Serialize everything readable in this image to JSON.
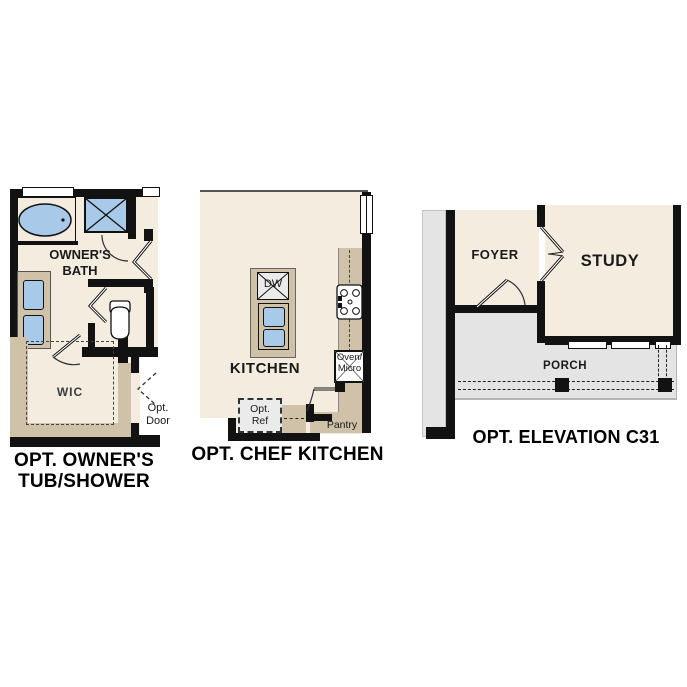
{
  "colors": {
    "wall": "#121212",
    "floor": "#f3ecdf",
    "fixture_blue": "#a9c9e9",
    "cabinet_tan": "#cfc2a8",
    "porch_gray": "#e4e4e4",
    "appliance_gray": "#ebebeb"
  },
  "plans": {
    "owners": {
      "caption_line1": "OPT. OWNER'S",
      "caption_line2": "TUB/SHOWER",
      "bath_label_line1": "OWNER'S",
      "bath_label_line2": "BATH",
      "wic_label": "WIC",
      "opt_door_line1": "Opt.",
      "opt_door_line2": "Door"
    },
    "kitchen": {
      "caption": "OPT. CHEF KITCHEN",
      "room_label": "KITCHEN",
      "dw_label": "DW",
      "oven_line1": "Oven/",
      "oven_line2": "Micro",
      "ref_line1": "Opt.",
      "ref_line2": "Ref",
      "pantry_label": "Pantry"
    },
    "elevation": {
      "caption": "OPT. ELEVATION C31",
      "foyer_label": "FOYER",
      "study_label": "STUDY",
      "porch_label": "PORCH"
    }
  }
}
